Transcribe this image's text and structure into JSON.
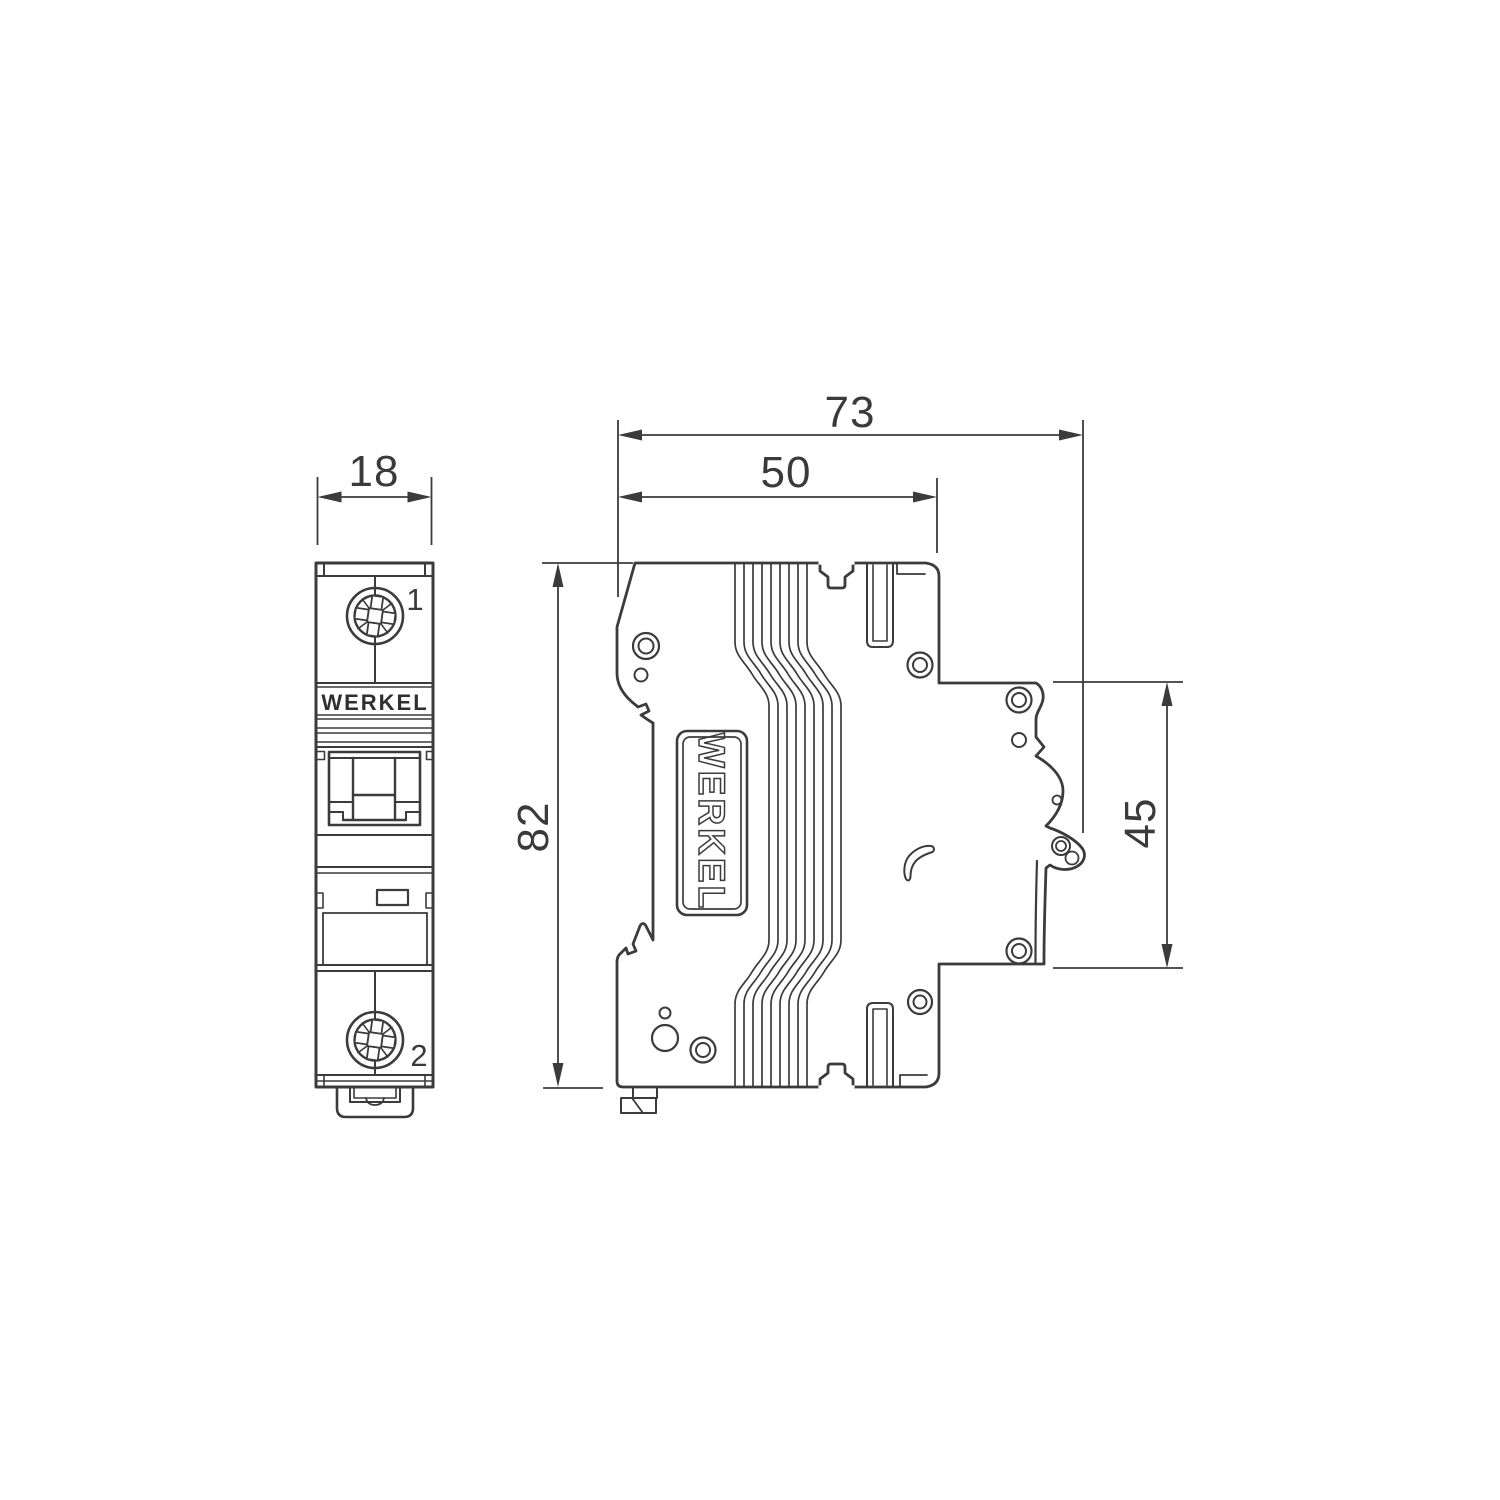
{
  "palette": {
    "background": "#ffffff",
    "line": "#3b3b3b",
    "dim_text": "#3a3a3a",
    "brand_text": "#2f2f2f"
  },
  "front_view": {
    "brand_label": "WERKEL",
    "terminal_top_label": "1",
    "terminal_bottom_label": "2"
  },
  "side_view": {
    "brand_label": "WERKEL"
  },
  "dimensions_mm": {
    "front_width": "18",
    "overall_depth": "73",
    "body_depth": "50",
    "height": "82",
    "mount_recess": "45"
  }
}
